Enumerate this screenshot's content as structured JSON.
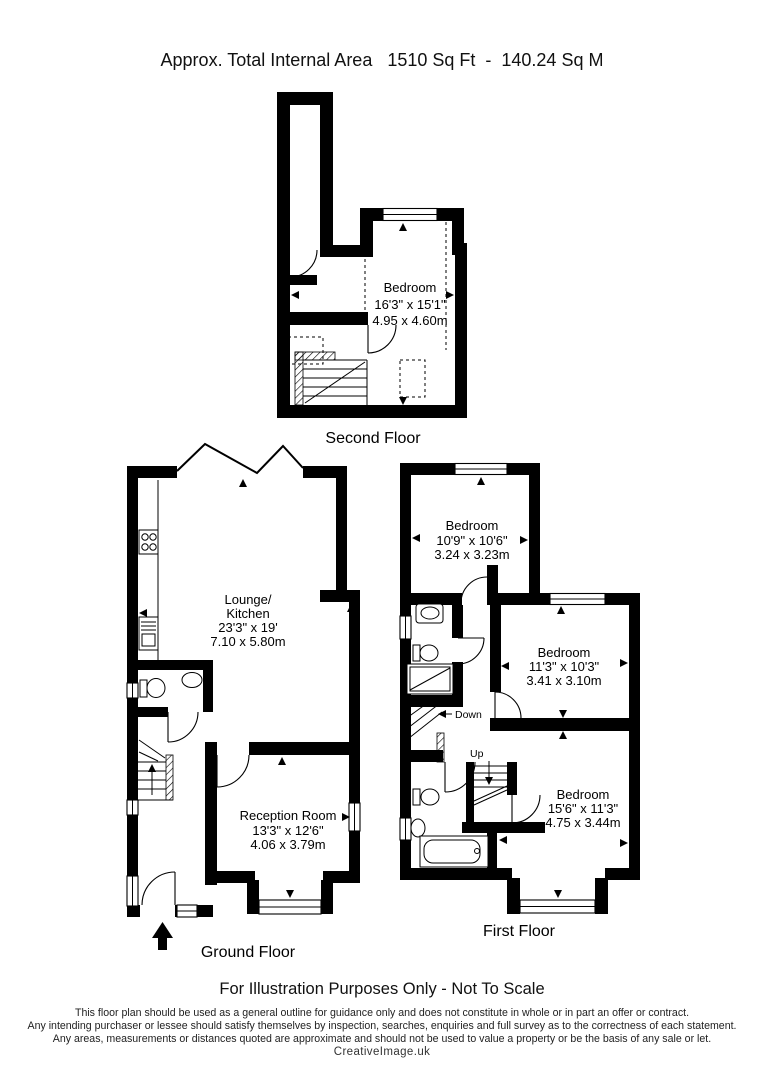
{
  "title": "Approx. Total Internal Area   1510 Sq Ft  -  140.24 Sq M",
  "colors": {
    "walls": "#000000",
    "background": "#ffffff",
    "text": "#000000"
  },
  "floors": {
    "second": {
      "label": "Second Floor",
      "room": {
        "name": "Bedroom",
        "imperial": "16'3\" x 15'1\"",
        "metric": "4.95 x 4.60m"
      }
    },
    "ground": {
      "label": "Ground Floor",
      "lounge": {
        "name_line1": "Lounge/",
        "name_line2": "Kitchen",
        "imperial": "23'3\" x 19'",
        "metric": "7.10 x 5.80m"
      },
      "reception": {
        "name": "Reception Room",
        "imperial": "13'3\" x 12'6\"",
        "metric": "4.06 x 3.79m"
      }
    },
    "first": {
      "label": "First Floor",
      "stair_down_label": "Down",
      "stair_up_label": "Up",
      "bedroom_front": {
        "name": "Bedroom",
        "imperial": "10'9\" x 10'6\"",
        "metric": "3.24 x 3.23m"
      },
      "bedroom_middle": {
        "name": "Bedroom",
        "imperial": "11'3\" x 10'3\"",
        "metric": "3.41 x 3.10m"
      },
      "bedroom_rear": {
        "name": "Bedroom",
        "imperial": "15'6\" x 11'3\"",
        "metric": "4.75 x 3.44m"
      }
    }
  },
  "footer": {
    "notice": "For Illustration Purposes Only - Not To Scale",
    "disclaimer": [
      "This floor plan should be used as a general outline for guidance only and does not constitute in whole or in part an offer or contract.",
      "Any intending purchaser or lessee should satisfy themselves by inspection, searches, enquiries and full survey as to the correctness of each statement.",
      "Any areas, measurements or distances quoted are approximate and should not be used to value a property or be the basis of any sale or let."
    ],
    "brand": "CreativeImage.uk"
  }
}
